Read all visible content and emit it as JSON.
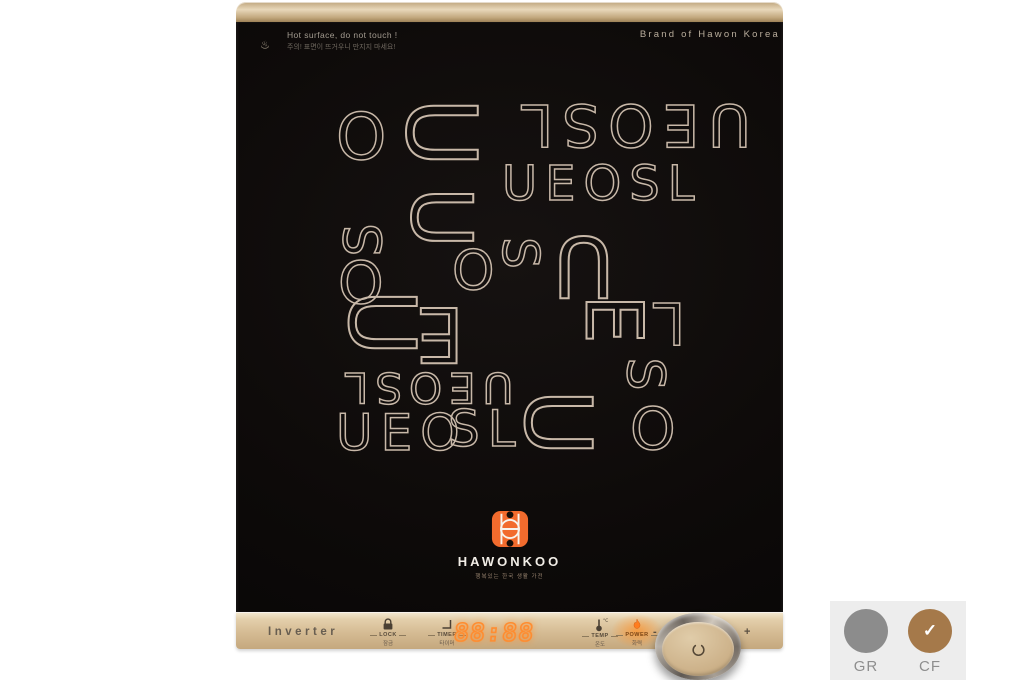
{
  "product": {
    "warning": {
      "line1": "Hot surface, do not touch !",
      "line2": "주의! 표면이 뜨거우니 만지지 마세요!"
    },
    "brand_top": "Brand of Hawon Korea",
    "pattern": {
      "color": "#c8b8a8",
      "letters": [
        {
          "t": "O",
          "x": 336,
          "y": 106,
          "s": 64,
          "r": 0
        },
        {
          "t": "U",
          "x": 398,
          "y": 92,
          "s": 96,
          "r": 90
        },
        {
          "t": "UEOSL",
          "x": 512,
          "y": 96,
          "s": 58,
          "r": 180
        },
        {
          "t": "UEOSL",
          "x": 502,
          "y": 160,
          "s": 48,
          "r": 0
        },
        {
          "t": "U",
          "x": 404,
          "y": 182,
          "s": 84,
          "r": 90
        },
        {
          "t": "S",
          "x": 344,
          "y": 210,
          "s": 52,
          "r": -90
        },
        {
          "t": "O",
          "x": 338,
          "y": 254,
          "s": 58,
          "r": 0
        },
        {
          "t": "U",
          "x": 340,
          "y": 284,
          "s": 92,
          "r": 90
        },
        {
          "t": "E",
          "x": 404,
          "y": 296,
          "s": 76,
          "r": 180
        },
        {
          "t": "O",
          "x": 452,
          "y": 244,
          "s": 54,
          "r": 0
        },
        {
          "t": "S",
          "x": 500,
          "y": 232,
          "s": 50,
          "r": 90
        },
        {
          "t": "U",
          "x": 540,
          "y": 224,
          "s": 84,
          "r": 180
        },
        {
          "t": "E",
          "x": 582,
          "y": 286,
          "s": 78,
          "r": 90
        },
        {
          "t": "L",
          "x": 644,
          "y": 294,
          "s": 58,
          "r": 180
        },
        {
          "t": "S",
          "x": 624,
          "y": 352,
          "s": 52,
          "r": 90
        },
        {
          "t": "UEOSL",
          "x": 338,
          "y": 366,
          "s": 42,
          "r": 180
        },
        {
          "t": "UEO",
          "x": 336,
          "y": 408,
          "s": 50,
          "r": 0
        },
        {
          "t": "SL",
          "x": 448,
          "y": 404,
          "s": 50,
          "r": 0
        },
        {
          "t": "U",
          "x": 516,
          "y": 384,
          "s": 92,
          "r": 90
        },
        {
          "t": "O",
          "x": 630,
          "y": 400,
          "s": 58,
          "r": 0
        }
      ]
    },
    "logo": {
      "name": "HAWONKOO",
      "tagline": "행복있는 한국 생활 가전",
      "accent_color": "#f26b2d"
    },
    "panel": {
      "inverter_label": "Inverter",
      "display_value": "88:88",
      "minus": "-",
      "plus": "+",
      "colors": {
        "panel": "#d5bb93",
        "display": "#ff8c2f",
        "flame": "#ff7d1f"
      },
      "buttons": [
        {
          "id": "lock",
          "label": "LOCK",
          "label_kr": "잠금"
        },
        {
          "id": "timer",
          "label": "TIMER",
          "label_kr": "타이머"
        },
        {
          "id": "temp",
          "label": "TEMP",
          "label_kr": "온도"
        },
        {
          "id": "power",
          "label": "POWER",
          "label_kr": "화력",
          "active": true
        }
      ]
    }
  },
  "swatches": {
    "check": "✓",
    "items": [
      {
        "code": "GR",
        "color": "#8c8c8c",
        "selected": false
      },
      {
        "code": "CF",
        "color": "#a5794a",
        "selected": true
      }
    ]
  }
}
